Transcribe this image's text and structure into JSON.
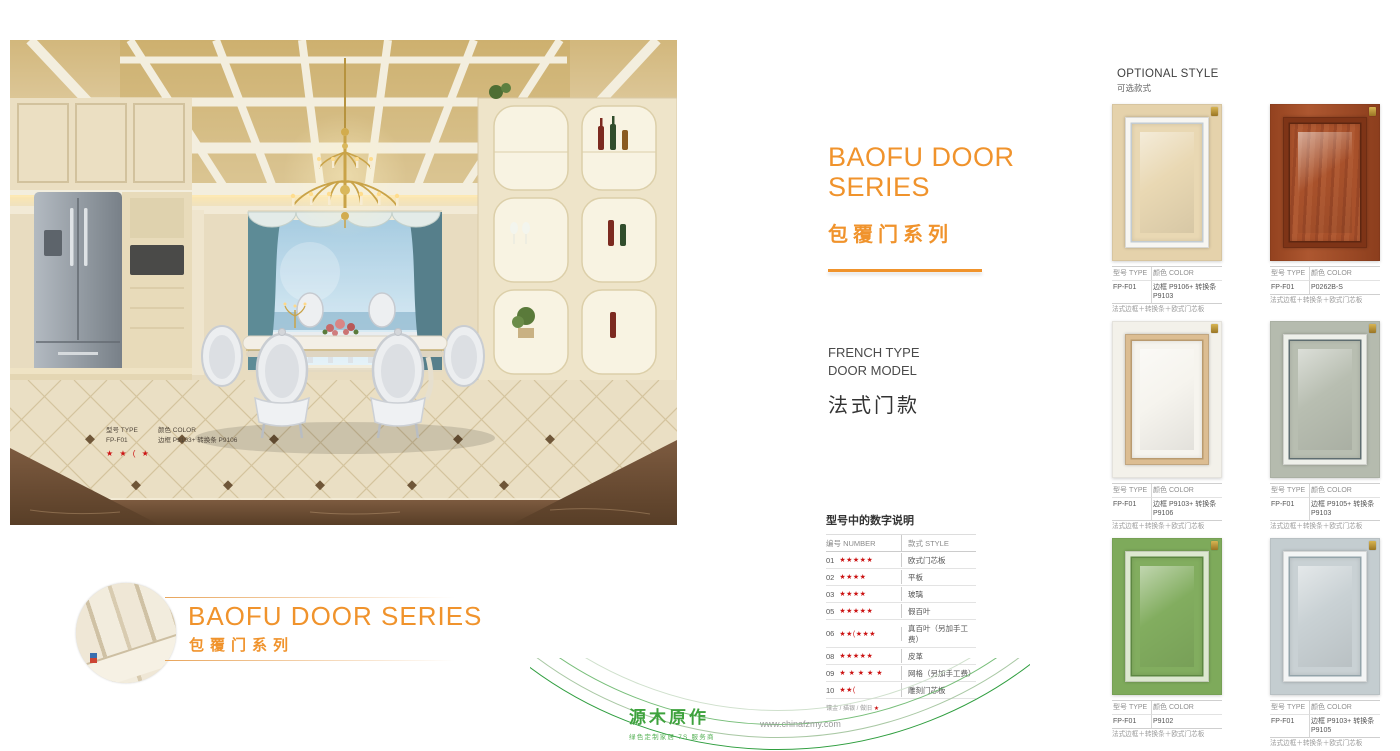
{
  "theme": {
    "accent": "#f0932c",
    "star_red": "#cc1414",
    "logo_green": "#3ea23d"
  },
  "headline": {
    "title_line1": "BAOFU DOOR",
    "title_line2": "SERIES",
    "title_cn": "包覆门系列"
  },
  "section": {
    "en_line1": "FRENCH TYPE",
    "en_line2": "DOOR MODEL",
    "cn": "法式门款"
  },
  "photo_tag": {
    "type_label": "型号 TYPE",
    "color_label": "颜色 COLOR",
    "model": "FP-F01",
    "color": "边框 P9103+ 转换条 P9106",
    "stars": "★ ★ ( ★"
  },
  "number_table": {
    "title": "型号中的数字说明",
    "header_number": "编号 NUMBER",
    "header_style": "款式 STYLE",
    "rows": [
      {
        "num": "01",
        "stars": "★★★★★",
        "style": "欧式门芯板"
      },
      {
        "num": "02",
        "stars": "★★★★",
        "style": "平板"
      },
      {
        "num": "03",
        "stars": "★★★★",
        "style": "玻璃"
      },
      {
        "num": "05",
        "stars": "★★★★★",
        "style": "假百叶"
      },
      {
        "num": "06",
        "stars": "★★(★★★",
        "style": "真百叶（另加手工费）"
      },
      {
        "num": "08",
        "stars": "★★★★★",
        "style": "皮革"
      },
      {
        "num": "09",
        "stars": "★ ★ ★ ★ ★",
        "style": "网格（另加手工费）"
      },
      {
        "num": "10",
        "stars": "★★(",
        "style": "雕刻门芯板"
      }
    ],
    "footnote": "镶金 / 描银 / 做旧",
    "footnote_star": "★"
  },
  "optional_style": {
    "en": "OPTIONAL STYLE",
    "cn": "可选款式"
  },
  "door_header": {
    "type": "型号 TYPE",
    "color": "颜色 COLOR"
  },
  "doors": [
    {
      "model": "FP-F01",
      "color": "边框 P9106+ 转换条 P9103",
      "desc": "法式边框＋转换条＋欧式门芯板",
      "colors": {
        "frame": "#e5d2ab",
        "trim": "#f7f6f2",
        "panel": "#e9d8b3",
        "line": "#c2cbd1"
      }
    },
    {
      "model": "FP-F01",
      "color": "P0262B-S",
      "desc": "法式边框＋转换条＋欧式门芯板",
      "colors": {
        "frame": "#a34c28",
        "trim": "#7e3417",
        "panel": "#a8522c",
        "line": "#5e2610"
      }
    },
    {
      "model": "FP-F01",
      "color": "边框 P9103+ 转换条 P9106",
      "desc": "法式边框＋转换条＋欧式门芯板",
      "colors": {
        "frame": "#f3f1ea",
        "trim": "#dcbd92",
        "panel": "#f6f4ee",
        "line": "#b99a6f"
      }
    },
    {
      "model": "FP-F01",
      "color": "边框 P9105+ 转换条 P9103",
      "desc": "法式边框＋转换条＋欧式门芯板",
      "colors": {
        "frame": "#b5bbae",
        "trim": "#eef0ea",
        "panel": "#b8beb1",
        "line": "#5e6d70"
      }
    },
    {
      "model": "FP-F01",
      "color": "P9102",
      "desc": "法式边框＋转换条＋欧式门芯板",
      "colors": {
        "frame": "#7eaa5b",
        "trim": "#dde8d0",
        "panel": "#82ad5f",
        "line": "#5d8742"
      }
    },
    {
      "model": "FP-F01",
      "color": "边框 P9103+ 转换条 P9105",
      "desc": "法式边框＋转换条＋欧式门芯板",
      "colors": {
        "frame": "#c4cdd0",
        "trim": "#f3f5f5",
        "panel": "#c9d1d4",
        "line": "#93a4aa"
      }
    }
  ],
  "footer_badge": {
    "title": "BAOFU DOOR SERIES",
    "cn": "包覆门系列"
  },
  "brand": {
    "logo": "源木原作",
    "tagline": "绿色定制家居 7S 服务商",
    "website": "www.chinafzmy.com"
  }
}
